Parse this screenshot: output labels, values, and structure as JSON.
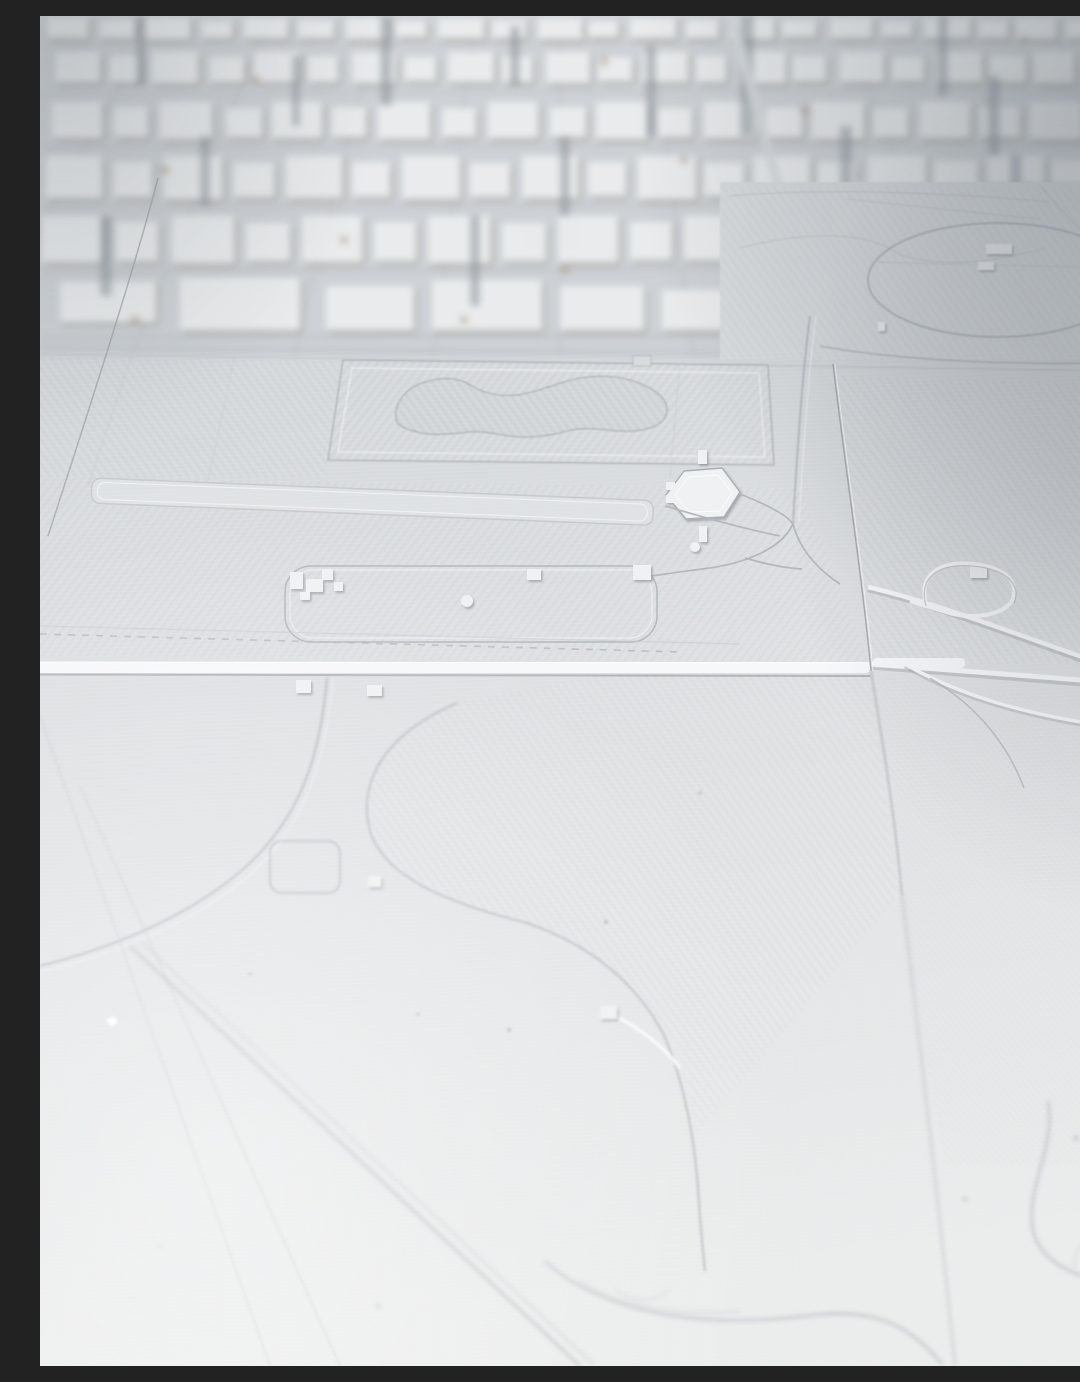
{
  "meta": {
    "kind": "photograph",
    "description": "Overhead oblique photo of a monochrome white 3D-printed city map model, assembled from printed tiles. Dense miniature building blocks fill the upper band, a flat engraved parkland with a kidney-shaped pond, a long reflecting pool, a hexagonal monument pad and an elliptical lawn occupy the middle, and a smooth out-of-focus plate with faint engraved roads fills the foreground."
  },
  "palette": {
    "bgTop": "#cdd1d5",
    "bgMid": "#d8dbde",
    "bgBottom": "#ebecec",
    "topBand": "#ced2d6",
    "plate": "#d8dbde",
    "building": "#e9ebec",
    "buildingShadow": "#8f887c",
    "streak": "#8e959d",
    "tan": "#b3a28c",
    "street": "#c3c7cb",
    "engrave": "#b2b7bc",
    "engraveSoft": "#c6cacd",
    "ridge": "#f7f8fa",
    "ridgeShadow": "#a5aaaf",
    "seam": "#9aa0a6",
    "pond": "#d2d5d8",
    "pondLine": "#b2b7bc",
    "pool": "#dfe2e4",
    "structure": "#eff1f2",
    "structureEdge": "#a9aeb3",
    "hatchLight": "rgba(255,255,255,0.55)",
    "hatchDark": "rgba(148,154,161,0.28)",
    "shadowTR": "rgba(98,106,114,0.42)",
    "shadowR": "rgba(118,124,131,0.30)",
    "brightBL": "rgba(255,255,255,0.40)"
  },
  "scene": {
    "label": "white 3D-printed city map model photographed at an angle",
    "regions": [
      {
        "name": "city-blocks-band",
        "note": "dense miniature building slabs, out of focus"
      },
      {
        "name": "museum-row",
        "note": "large flat-roofed slabs along the mall edge"
      },
      {
        "name": "park-with-pond",
        "note": "engraved rectangular park containing a peanut-shaped pond"
      },
      {
        "name": "reflecting-pool",
        "note": "long narrow recessed pool strip"
      },
      {
        "name": "hexagon-monument",
        "note": "raised hexagonal pad with small posts"
      },
      {
        "name": "ellipse-lawn",
        "note": "large engraved ellipse with tiny structures"
      },
      {
        "name": "highway-interchange",
        "note": "raised white ramps right of the tile seam"
      },
      {
        "name": "tile-seams",
        "note": "horizontal raised seam road and slanted vertical seam between printed tiles"
      },
      {
        "name": "foreground-plate",
        "note": "smooth bright surface with faint engraved curves and diagonal avenue, out of focus"
      }
    ]
  }
}
